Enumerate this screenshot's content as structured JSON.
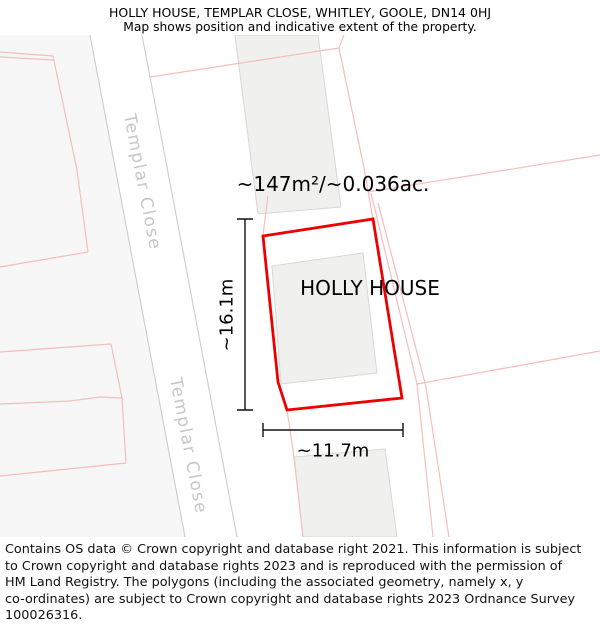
{
  "header": {
    "title": "HOLLY HOUSE, TEMPLAR CLOSE, WHITLEY, GOOLE, DN14 0HJ",
    "subtitle": "Map shows position and indicative extent of the property."
  },
  "map": {
    "property_name": "HOLLY HOUSE",
    "area_label": "~147m²/~0.036ac.",
    "dimensions": {
      "width": "~11.7m",
      "height": "~16.1m"
    },
    "road_name": "Templar Close",
    "colors": {
      "property_outline": "#ee0000",
      "parcel_line": "#f6bdbd",
      "building_fill": "#f0f0ef",
      "building_stroke": "#d8d8d8",
      "road_line": "#cccccc",
      "roadside_tint": "#f7f7f7",
      "dimension_line": "#111111"
    }
  },
  "footer": {
    "lines": [
      "Contains OS data © Crown copyright and database right 2021. This information is subject",
      "to Crown copyright and database rights 2023 and is reproduced with the permission of",
      "HM Land Registry. The polygons (including the associated geometry, namely x, y",
      "co-ordinates) are subject to Crown copyright and database rights 2023 Ordnance Survey",
      "100026316."
    ]
  }
}
